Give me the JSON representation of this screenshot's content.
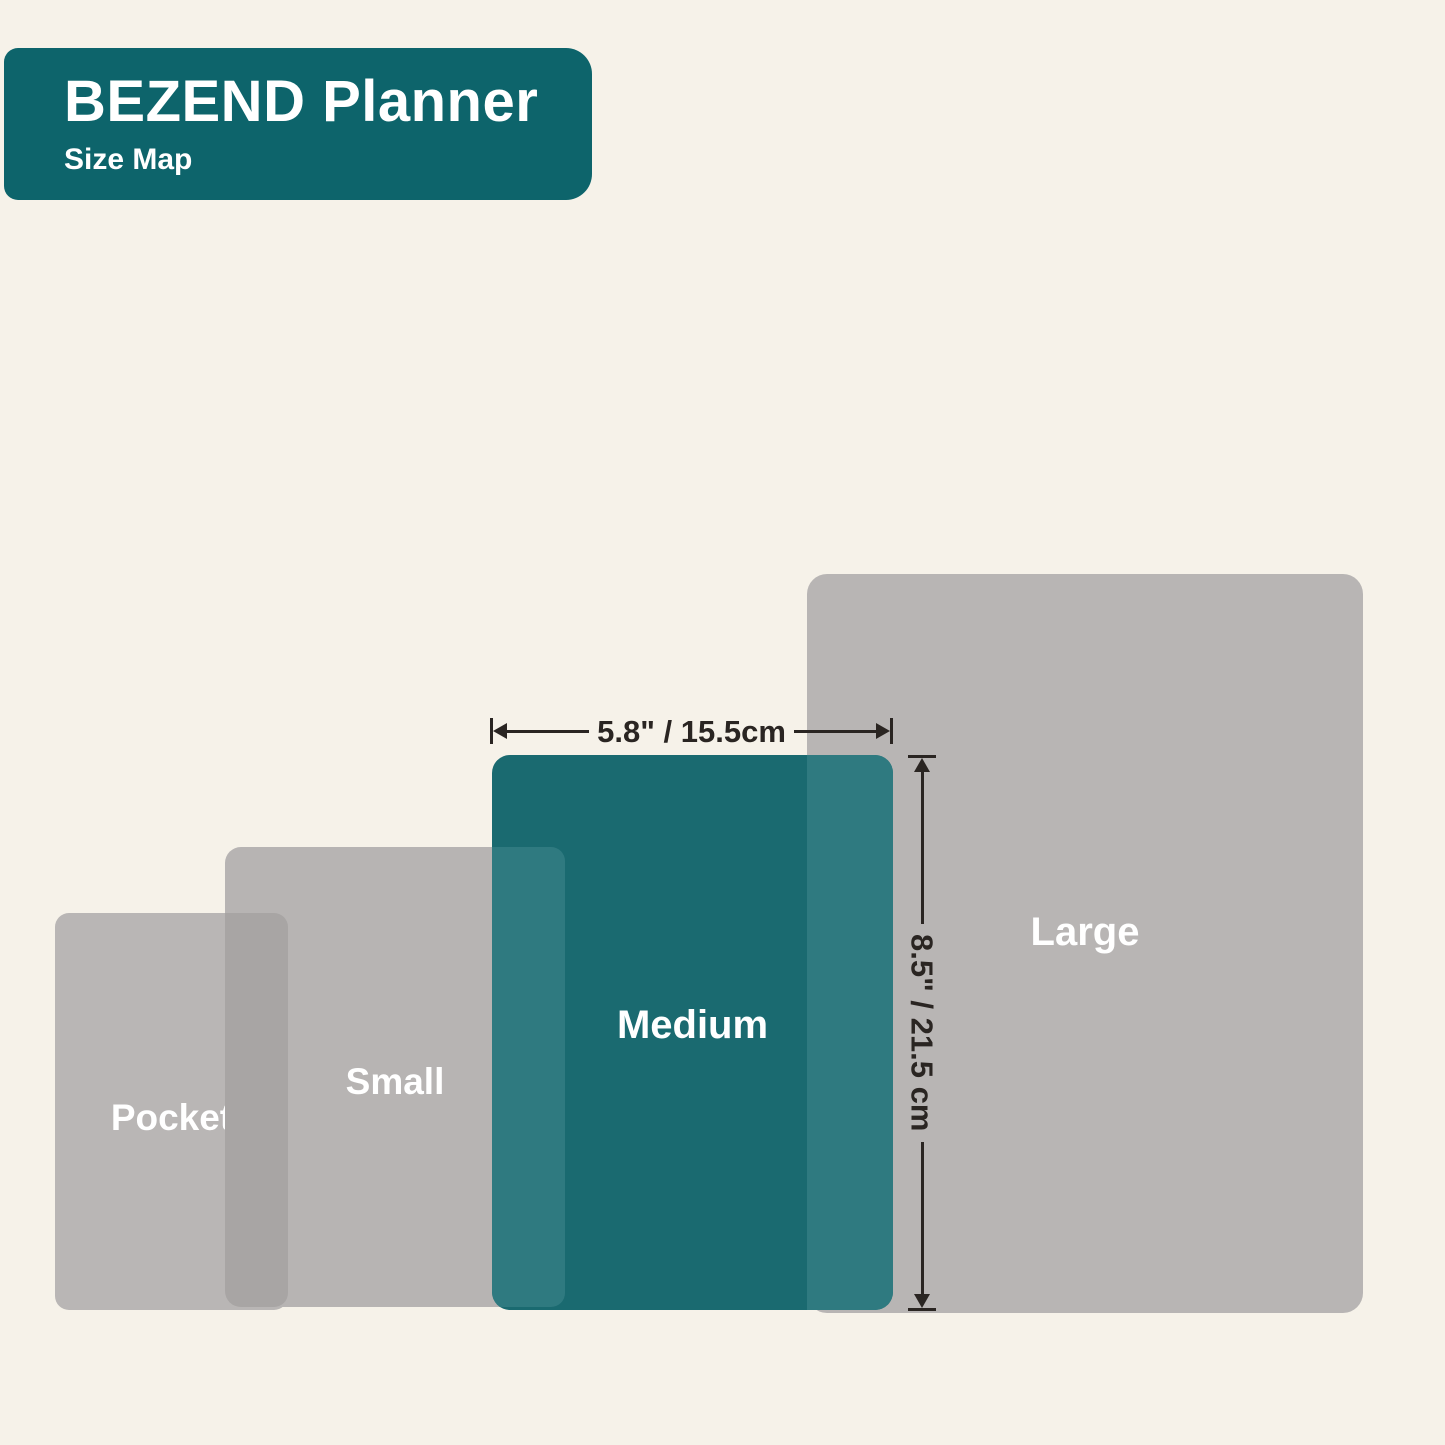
{
  "header": {
    "title": "BEZEND Planner",
    "subtitle": "Size Map"
  },
  "sizes": [
    {
      "label": "Pocket"
    },
    {
      "label": "Small"
    },
    {
      "label": "Medium",
      "width_label": "5.8\" / 15.5cm",
      "height_label": "8.5\" / 21.5 cm"
    },
    {
      "label": "Large"
    }
  ],
  "colors": {
    "background": "#f6f2e9",
    "header_teal": "#0d646b",
    "medium_teal": "#1a6a70",
    "overlap_teal": "#2f7a80",
    "gray": "#b8b5b4",
    "overlap_gray": "#a8a5a4",
    "label_text": "#ffffff",
    "annotation": "#2a2522"
  }
}
